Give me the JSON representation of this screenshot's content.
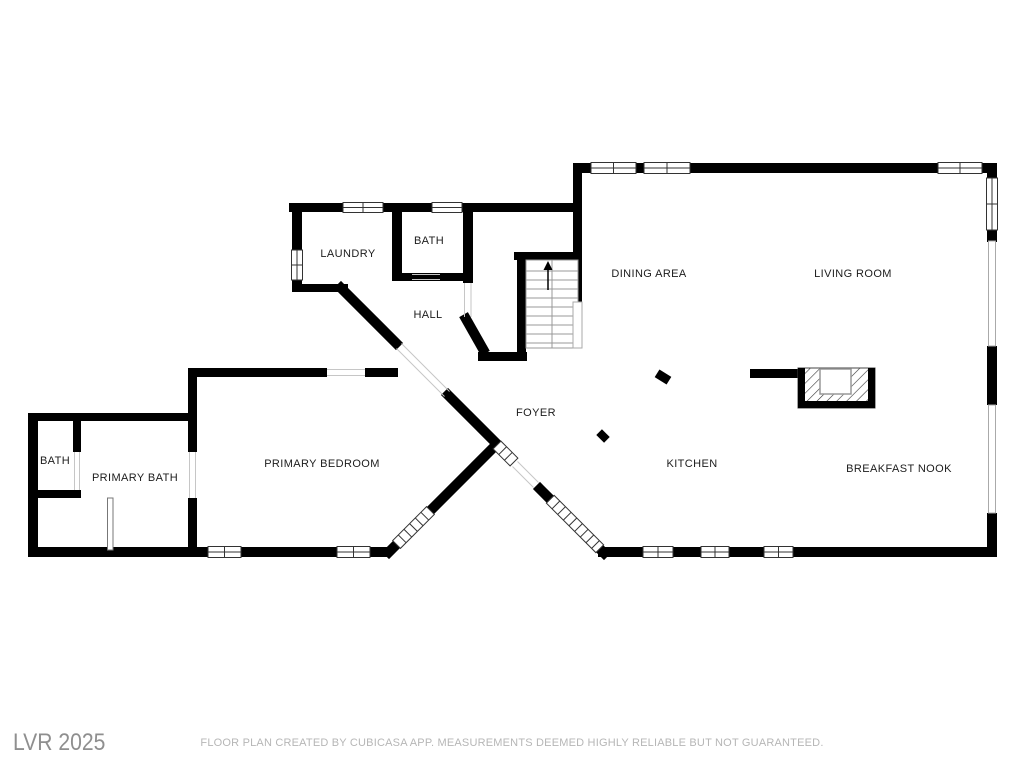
{
  "floor_plan": {
    "title": "Main floor plan",
    "rooms": {
      "laundry": "LAUNDRY",
      "bath_upper": "BATH",
      "hall": "HALL",
      "dining_area": "DINING AREA",
      "living_room": "LIVING ROOM",
      "foyer": "FOYER",
      "kitchen": "KITCHEN",
      "breakfast_nook": "BREAKFAST NOOK",
      "primary_bedroom": "PRIMARY BEDROOM",
      "primary_bath": "PRIMARY BATH",
      "bath_small": "BATH"
    },
    "stairs": {
      "icon": "up-arrow-icon",
      "direction": "up"
    },
    "colors": {
      "wall": "#000000",
      "label_text": "#1c1c1c",
      "watermark_gray": "#8f8f8f",
      "disclaimer_gray": "#b6b6b6",
      "background": "#ffffff"
    }
  },
  "footer": {
    "watermark": "LVR 2025",
    "disclaimer": "FLOOR PLAN CREATED BY CUBICASA APP. MEASUREMENTS DEEMED HIGHLY RELIABLE BUT NOT GUARANTEED."
  }
}
